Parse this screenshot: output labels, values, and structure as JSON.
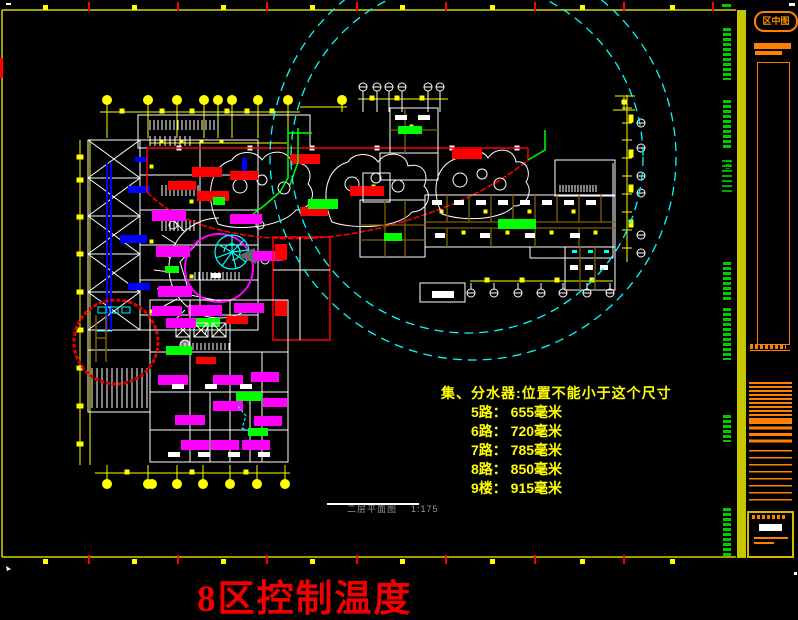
{
  "colors": {
    "background": "#000000",
    "frame_yellow": "#d4d400",
    "grid_yellow": "#ffff00",
    "wall_white": "#ffffff",
    "wall_olive": "#806000",
    "bar_magenta": "#ff00ff",
    "bar_green": "#00ff00",
    "bar_blue": "#0000ff",
    "bar_red": "#ff0000",
    "construction_cyan": "#00ffff",
    "panel_orange": "#ff8000",
    "panel_band_yellow": "#c6c600",
    "micro_text_green": "#00cc00",
    "caption_gray": "#969696",
    "zone_text_red": "#f20000"
  },
  "title_block": {
    "logo_text": "区中图",
    "tel_text": "TEL"
  },
  "annotation": {
    "title": "集、分水器:位置不能小于这个尺寸",
    "rows": [
      "5路： 655毫米",
      "6路： 720毫米",
      "7路： 785毫米",
      "8路： 850毫米",
      "9楼： 915毫米"
    ]
  },
  "plan_caption": {
    "name": "二层平面图",
    "scale": "1:175"
  },
  "zone_label": "8区控制温度"
}
